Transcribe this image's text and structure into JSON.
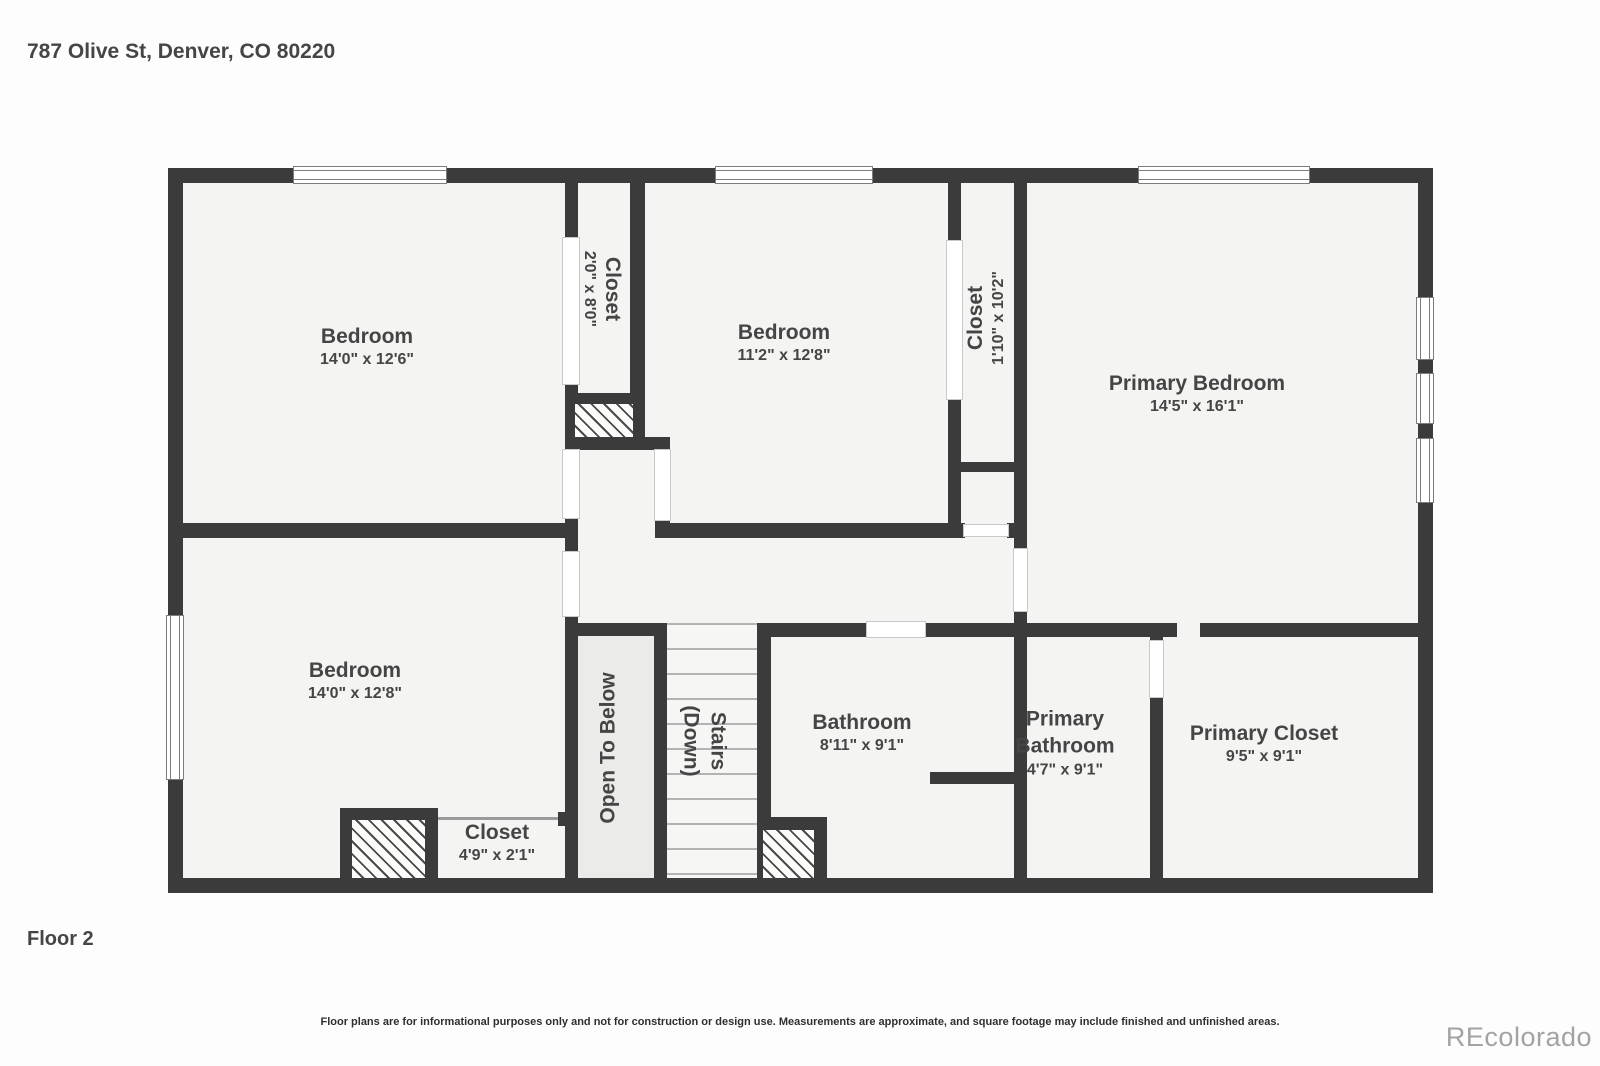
{
  "header": {
    "address": "787 Olive St, Denver, CO 80220"
  },
  "footer": {
    "floor_label": "Floor 2",
    "disclaimer": "Floor plans are for informational purposes only and not for construction or design use. Measurements are approximate, and square footage may include finished and unfinished areas.",
    "watermark": "REcolorado"
  },
  "rooms": {
    "bedroom1": {
      "name": "Bedroom",
      "dims": "14'0\" x 12'6\""
    },
    "closet1": {
      "name": "Closet",
      "dims": "2'0\" x 8'0\""
    },
    "bedroom2": {
      "name": "Bedroom",
      "dims": "11'2\" x 12'8\""
    },
    "closet2": {
      "name": "Closet",
      "dims": "1'10\" x 10'2\""
    },
    "primary_bedroom": {
      "name": "Primary Bedroom",
      "dims": "14'5\" x 16'1\""
    },
    "bedroom3": {
      "name": "Bedroom",
      "dims": "14'0\" x 12'8\""
    },
    "open_to_below": {
      "name": "Open To Below"
    },
    "stairs": {
      "name": "Stairs",
      "sub": "(Down)"
    },
    "bathroom": {
      "name": "Bathroom",
      "dims": "8'11\" x 9'1\""
    },
    "primary_bathroom": {
      "name": "Primary Bathroom",
      "dims": "4'7\" x 9'1\""
    },
    "primary_closet": {
      "name": "Primary Closet",
      "dims": "9'5\" x 9'1\""
    },
    "closet3": {
      "name": "Closet",
      "dims": "4'9\" x 2'1\""
    }
  },
  "colors": {
    "wall": "#3b3b3b",
    "fill": "#f4f4f2",
    "otb": "#ebebea",
    "text": "#454545",
    "watermark": "#a3a3a3"
  }
}
